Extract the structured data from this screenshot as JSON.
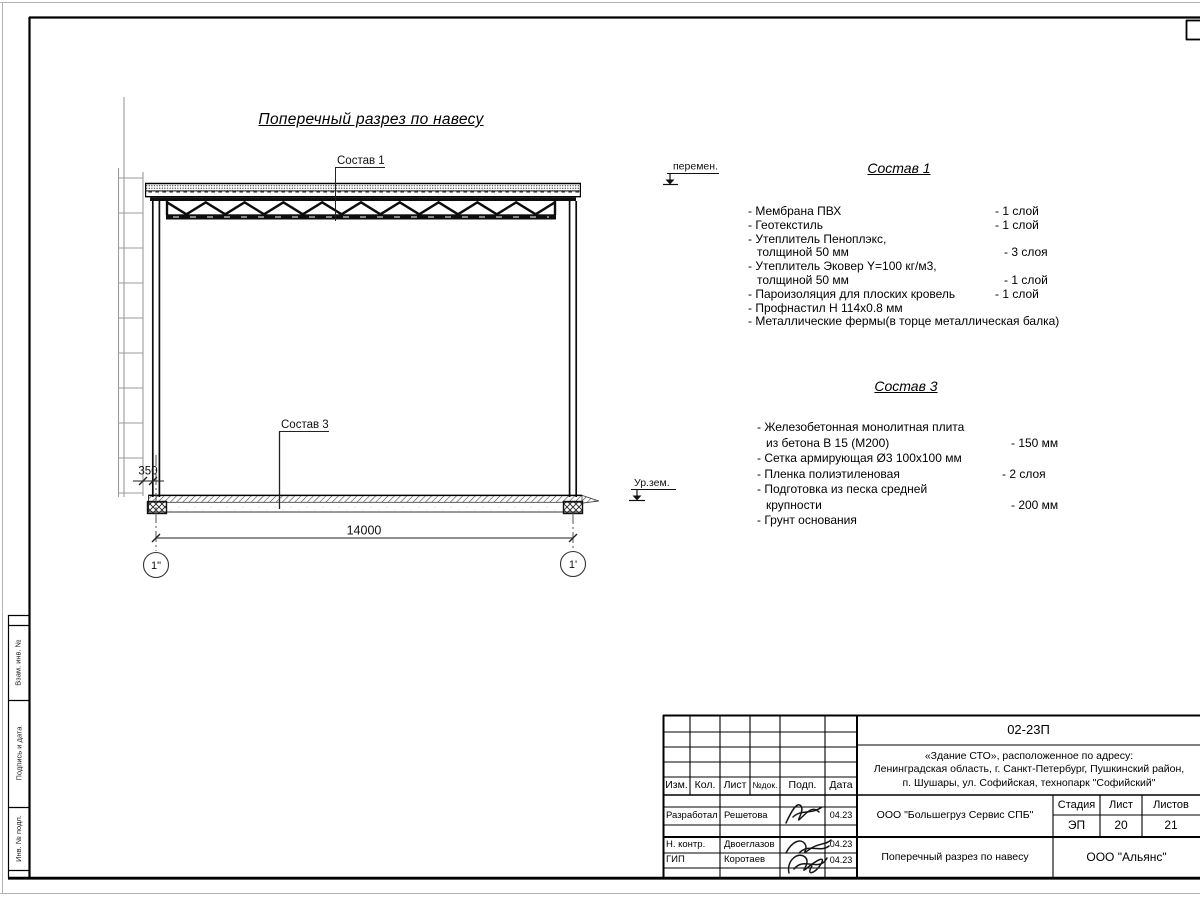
{
  "sheet": {
    "drawing_title": "Поперечный разрез по навесу",
    "labels": {
      "sostav1_tag": "Состав 1",
      "sostav3_tag": "Состав 3",
      "level_top": "перемен.",
      "level_ground": "Ур.зем.",
      "dim_small": "350",
      "dim_span": "14000",
      "axis_left": "1\"",
      "axis_right": "1'"
    }
  },
  "sostav1": {
    "title": "Состав 1",
    "items": [
      {
        "name": "- Мембрана ПВХ",
        "value": "- 1 слой"
      },
      {
        "name": "- Геотекстиль",
        "value": "- 1 слой"
      },
      {
        "name": "- Утеплитель Пеноплэкс,",
        "value": ""
      },
      {
        "name": "толщиной 50 мм",
        "value": "- 3 слоя"
      },
      {
        "name": "- Утеплитель Эковер Y=100 кг/м3,",
        "value": ""
      },
      {
        "name": "толщиной 50 мм",
        "value": "- 1 слой"
      },
      {
        "name": "- Пароизоляция для плоских кровель",
        "value": "- 1 слой"
      },
      {
        "name": "- Профнастил Н 114х0.8 мм",
        "value": ""
      },
      {
        "name": "- Металлические фермы(в торце металлическая балка)",
        "value": ""
      }
    ]
  },
  "sostav3": {
    "title": "Состав 3",
    "items": [
      {
        "name": "- Железобетонная  монолитная плита",
        "value": ""
      },
      {
        "name": "из бетона В 15 (М200)",
        "value": "- 150 мм"
      },
      {
        "name": "- Сетка армирующая Ø3 100х100 мм",
        "value": ""
      },
      {
        "name": "- Пленка полиэтиленовая",
        "value": "-  2 слоя"
      },
      {
        "name": "- Подготовка из песка средней",
        "value": ""
      },
      {
        "name": "крупности",
        "value": "- 200 мм"
      },
      {
        "name": "- Грунт основания",
        "value": ""
      }
    ]
  },
  "title_block": {
    "doc_number": "02-23П",
    "address_line1": "«Здание СТО», расположенное по адресу:",
    "address_line2": "Ленинградская область, г. Санкт-Петербург, Пушкинский район,",
    "address_line3": "п. Шушары, ул. Софийская, технопарк \"Софийский\"",
    "col_izm": "Изм.",
    "col_kol": "Кол.",
    "col_list": "Лист",
    "col_ndok": "№док.",
    "col_podp": "Подп.",
    "col_data": "Дата",
    "rows": [
      {
        "role": "Разработал",
        "name": "Решетова",
        "date": "04.23"
      },
      {
        "role": "Н. контр.",
        "name": "Двоеглазов",
        "date": "04.23"
      },
      {
        "role": "ГИП",
        "name": "Коротаев",
        "date": "04.23"
      }
    ],
    "org": "ООО \"Большегруз Сервис СПБ\"",
    "stage_label": "Стадия",
    "sheet_label": "Лист",
    "sheets_label": "Листов",
    "stage": "ЭП",
    "sheet_no": "20",
    "sheets_total": "21",
    "drawing_title": "Поперечный разрез по навесу",
    "company": "ООО \"Альянс\""
  },
  "margin": {
    "vzam": "Взам. инв. №",
    "podp_data": "Подпись и дата",
    "inv_podl": "Инв. № подл."
  }
}
